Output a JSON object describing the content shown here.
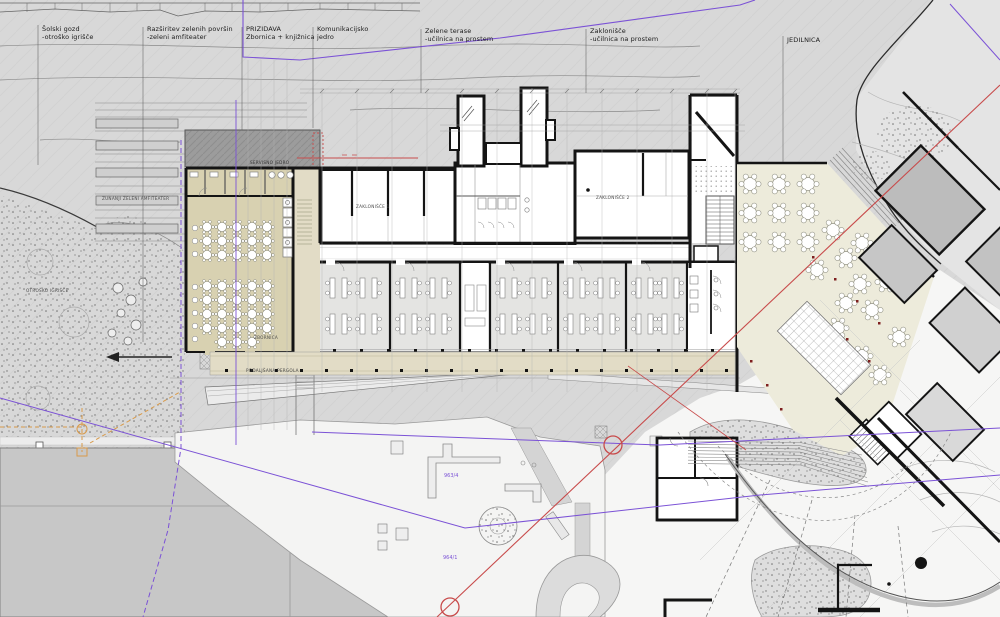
{
  "colors": {
    "terrain": "#d8d8d8",
    "terrain_light": "#e4e4e4",
    "beige": "#d8d1b1",
    "beige_light": "#e2dcc6",
    "cream": "#edebdb",
    "dark_strip": "#9c9c9c",
    "field": "#c7c7c7",
    "room_gray": "#e4e4e2",
    "purple": "#7b52d6",
    "red": "#c84b4b",
    "orange": "#d89a4a"
  },
  "labels": {
    "top": [
      {
        "l1": "Šolski gozd",
        "l2": "-otroško igrišče"
      },
      {
        "l1": "Razširitev zelenih površin",
        "l2": "-zeleni amfiteater"
      },
      {
        "l1": "PRIZIDAVA",
        "l2": "Zbornica + knjižnica"
      },
      {
        "l1": "Komunikacijsko",
        "l2": "jedro"
      },
      {
        "l1": "Zelene terase",
        "l2": "-učilnica na prostem"
      },
      {
        "l1": "Zaklonišče",
        "l2": "-učilnica na prostem"
      },
      {
        "l1": "JEDILNICA",
        "l2": ""
      }
    ],
    "plan": {
      "amphitheater": "ZUNANJI ZELENI AMFITEATER",
      "playground": "OTROŠKO IGRIŠČE",
      "service_core": "SERVISNO JEDRO",
      "staff_room": "ZBORNICA",
      "pergola": "PODALJŠANA PERGOLA",
      "shelter_1": "ZAKLONIŠČE 1",
      "shelter_2": "ZAKLONIŠČE 2",
      "parcel_a": "963/4",
      "parcel_b": "964/1"
    }
  }
}
